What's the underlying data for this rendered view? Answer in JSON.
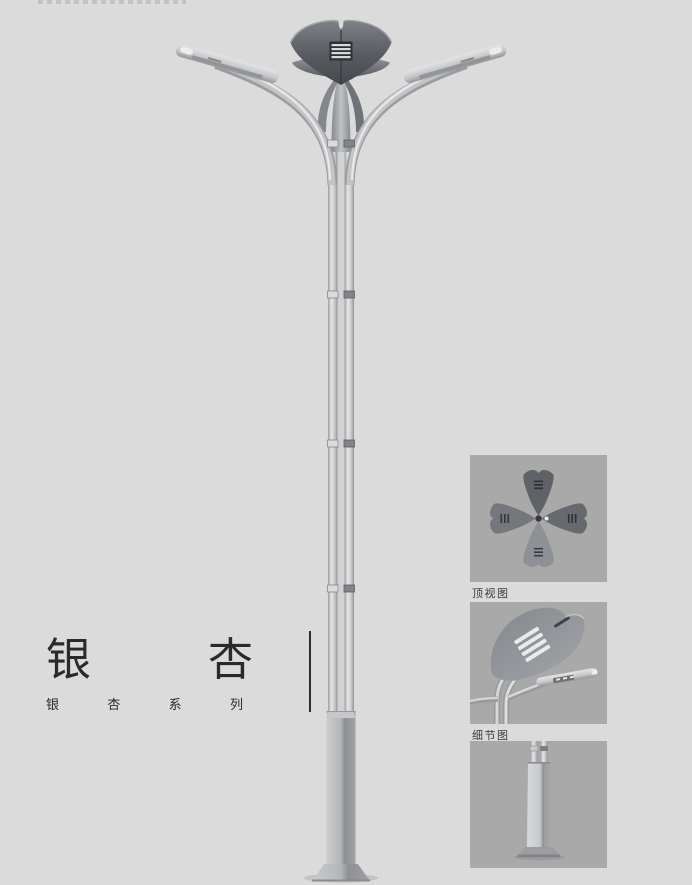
{
  "page": {
    "background": "#dbdbdb",
    "description_visible_text_only": true
  },
  "title_block": {
    "title": "银杏",
    "title_chars": [
      "银",
      "杏"
    ],
    "subtitle": "银杏系列",
    "subtitle_chars": [
      "银",
      "杏",
      "系",
      "列"
    ]
  },
  "detail_panels": {
    "top_view_label": "顶视图",
    "detail_view_label": "细节图",
    "base_view_label": ""
  },
  "figure": {
    "subject": "ginkgo-series-street-lamp",
    "parts": [
      "ginkgo-crown",
      "louver-panel",
      "left-arm",
      "right-arm",
      "left-lamp-head",
      "right-lamp-head",
      "twin-tube-pole",
      "pole-connector-bands",
      "square-base-column",
      "base-plate"
    ]
  },
  "colors": {
    "background": "#dbdbdb",
    "panel_background": "#a9a9a9",
    "crown_dark": "#55585c",
    "metal_light": "#c9cacc",
    "metal_mid": "#9a9c9f",
    "text": "#2b2a28"
  }
}
